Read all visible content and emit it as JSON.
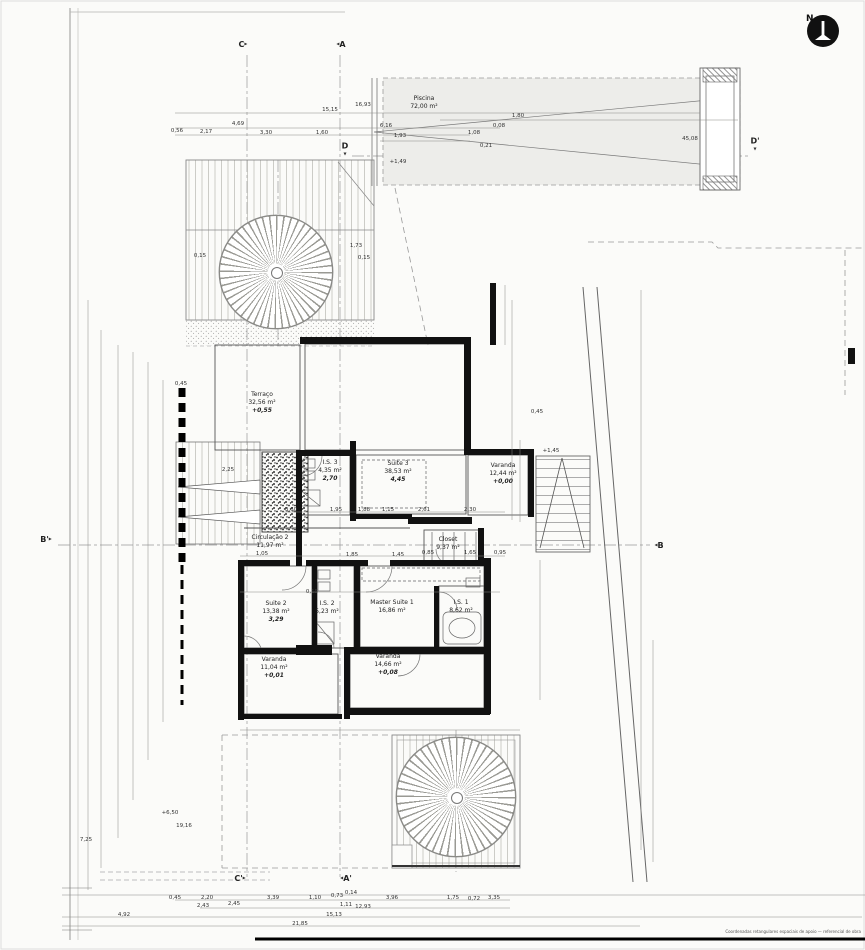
{
  "drawing": {
    "type": "architectural-floor-plan",
    "north_label": "N",
    "fine_print": "Coordenadas retangulares espaciais de apoio — referencial de obra"
  },
  "colors": {
    "paper": "#fbfbf9",
    "line": "#666666",
    "wall": "#111111",
    "dash": "#999999",
    "north_badge": "#111111"
  },
  "rooms": [
    {
      "name": "Piscina",
      "area": "72,00 m²",
      "x": 424,
      "y": 95
    },
    {
      "name": "Terraço",
      "area": "32,56 m²",
      "level": "+0,55",
      "x": 262,
      "y": 391
    },
    {
      "name": "Suite 3",
      "area": "38,53 m²",
      "level": "4,45",
      "x": 398,
      "y": 460
    },
    {
      "name": "I.S. 3",
      "area": "4,35 m²",
      "level": "2,70",
      "x": 330,
      "y": 459
    },
    {
      "name": "Varanda",
      "area": "12,44 m²",
      "level": "+0,00",
      "x": 503,
      "y": 462
    },
    {
      "name": "Circulação 2",
      "area": "11,97 m²",
      "x": 270,
      "y": 534
    },
    {
      "name": "Closet",
      "area": "9,37 m²",
      "x": 448,
      "y": 536
    },
    {
      "name": "Suite 2",
      "area": "13,38 m²",
      "level": "3,29",
      "x": 276,
      "y": 600
    },
    {
      "name": "I.S. 2",
      "area": "5,23 m²",
      "x": 327,
      "y": 600
    },
    {
      "name": "Master Suite 1",
      "area": "16,86 m²",
      "x": 392,
      "y": 599
    },
    {
      "name": "I.S. 1",
      "area": "8,62 m²",
      "x": 461,
      "y": 599
    },
    {
      "name": "Varanda",
      "area": "11,04 m²",
      "level": "+0,01",
      "x": 274,
      "y": 656
    },
    {
      "name": "Varanda",
      "area": "14,66 m²",
      "level": "+0,08",
      "x": 388,
      "y": 653
    }
  ],
  "section_markers": [
    {
      "label": "C",
      "tri": "▸",
      "pos": "after",
      "x": 243,
      "y": 45
    },
    {
      "label": "A",
      "tri": "◂",
      "pos": "before",
      "x": 341,
      "y": 45
    },
    {
      "label": "C'",
      "tri": "▸",
      "pos": "after",
      "x": 240,
      "y": 879
    },
    {
      "label": "A'",
      "tri": "◂",
      "pos": "before",
      "x": 346,
      "y": 879
    },
    {
      "label": "B'",
      "tri": "▸",
      "pos": "after",
      "x": 46,
      "y": 540
    },
    {
      "label": "B",
      "tri": "◂",
      "pos": "before",
      "x": 659,
      "y": 546
    },
    {
      "label": "D",
      "tri": "▾",
      "pos": "below",
      "x": 345,
      "y": 150
    },
    {
      "label": "D'",
      "tri": "▾",
      "pos": "below",
      "x": 755,
      "y": 145
    }
  ],
  "dimensions": [
    {
      "t": "0,56",
      "x": 177,
      "y": 131
    },
    {
      "t": "2,17",
      "x": 206,
      "y": 132
    },
    {
      "t": "4,69",
      "x": 238,
      "y": 124
    },
    {
      "t": "3,30",
      "x": 266,
      "y": 133
    },
    {
      "t": "1,60",
      "x": 322,
      "y": 133
    },
    {
      "t": "15,15",
      "x": 330,
      "y": 110
    },
    {
      "t": "16,93",
      "x": 363,
      "y": 105
    },
    {
      "t": "6,16",
      "x": 386,
      "y": 126
    },
    {
      "t": "1,93",
      "x": 400,
      "y": 136
    },
    {
      "t": "1,80",
      "x": 518,
      "y": 116
    },
    {
      "t": "1,08",
      "x": 474,
      "y": 133
    },
    {
      "t": "0,08",
      "x": 499,
      "y": 126
    },
    {
      "t": "0,21",
      "x": 486,
      "y": 146
    },
    {
      "t": "45,08",
      "x": 690,
      "y": 139
    },
    {
      "t": "+1,49",
      "x": 398,
      "y": 162
    },
    {
      "t": "0,15",
      "x": 200,
      "y": 256
    },
    {
      "t": "1,73",
      "x": 356,
      "y": 246
    },
    {
      "t": "0,15",
      "x": 364,
      "y": 258
    },
    {
      "t": "0,45",
      "x": 181,
      "y": 384
    },
    {
      "t": "2,25",
      "x": 228,
      "y": 470
    },
    {
      "t": "0,60",
      "x": 291,
      "y": 510
    },
    {
      "t": "1,95",
      "x": 336,
      "y": 510
    },
    {
      "t": "1,88",
      "x": 364,
      "y": 510
    },
    {
      "t": "1,15",
      "x": 388,
      "y": 510
    },
    {
      "t": "2,61",
      "x": 424,
      "y": 510
    },
    {
      "t": "2,30",
      "x": 470,
      "y": 510
    },
    {
      "t": "0,45",
      "x": 537,
      "y": 412
    },
    {
      "t": "+1,45",
      "x": 551,
      "y": 451
    },
    {
      "t": "1,05",
      "x": 262,
      "y": 554
    },
    {
      "t": "1,85",
      "x": 352,
      "y": 555
    },
    {
      "t": "1,45",
      "x": 398,
      "y": 555
    },
    {
      "t": "0,85",
      "x": 428,
      "y": 553
    },
    {
      "t": "1,65",
      "x": 470,
      "y": 553
    },
    {
      "t": "0,95",
      "x": 500,
      "y": 553
    },
    {
      "t": "0,15",
      "x": 312,
      "y": 592
    },
    {
      "t": "+6,50",
      "x": 170,
      "y": 813
    },
    {
      "t": "19,16",
      "x": 184,
      "y": 826
    },
    {
      "t": "7,25",
      "x": 86,
      "y": 840
    },
    {
      "t": "0,45",
      "x": 175,
      "y": 898
    },
    {
      "t": "2,20",
      "x": 207,
      "y": 898
    },
    {
      "t": "3,39",
      "x": 273,
      "y": 898
    },
    {
      "t": "1,10",
      "x": 315,
      "y": 898
    },
    {
      "t": "0,73",
      "x": 337,
      "y": 896
    },
    {
      "t": "0,14",
      "x": 351,
      "y": 893
    },
    {
      "t": "3,96",
      "x": 392,
      "y": 898
    },
    {
      "t": "1,75",
      "x": 453,
      "y": 898
    },
    {
      "t": "0,72",
      "x": 474,
      "y": 899
    },
    {
      "t": "3,35",
      "x": 494,
      "y": 898
    },
    {
      "t": "2,43",
      "x": 203,
      "y": 906
    },
    {
      "t": "2,45",
      "x": 234,
      "y": 904
    },
    {
      "t": "1,11",
      "x": 346,
      "y": 905
    },
    {
      "t": "12,93",
      "x": 363,
      "y": 907
    },
    {
      "t": "4,92",
      "x": 124,
      "y": 915
    },
    {
      "t": "15,13",
      "x": 334,
      "y": 915
    },
    {
      "t": "21,85",
      "x": 300,
      "y": 924
    }
  ]
}
